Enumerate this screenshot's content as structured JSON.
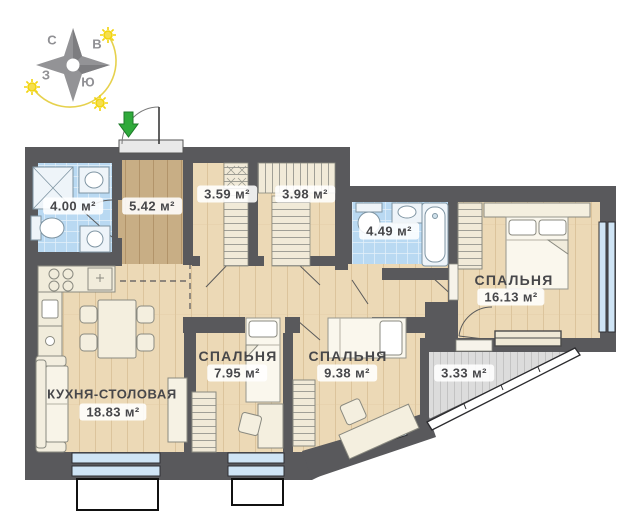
{
  "title": "Apartment floor plan",
  "compass": {
    "letters": {
      "north": "С",
      "east": "В",
      "west": "З",
      "south": "Ю"
    }
  },
  "rooms": {
    "bathroom_small": {
      "area_label": "4.00 м²"
    },
    "hallway": {
      "area_label": "5.42 м²"
    },
    "storage_1": {
      "area_label": "3.59 м²"
    },
    "storage_2": {
      "area_label": "3.98 м²"
    },
    "bathroom_main": {
      "area_label": "4.49 м²"
    },
    "bedroom_main": {
      "name": "СПАЛЬНЯ",
      "area_label": "16.13 м²"
    },
    "bedroom_left": {
      "name": "СПАЛЬНЯ",
      "area_label": "7.95 м²"
    },
    "bedroom_center": {
      "name": "СПАЛЬНЯ",
      "area_label": "9.38 м²"
    },
    "kitchen_dining": {
      "name": "КУХНЯ-СТОЛОВАЯ",
      "area_label": "18.83 м²"
    },
    "balcony": {
      "area_label": "3.33 м²"
    }
  },
  "colors": {
    "wall": "#59595c",
    "floor_wood": "#ecd9b6",
    "floor_wood_dark": "#c8ae85",
    "tile_blue": "#b9d9f2",
    "window_glass": "#cfe4f5",
    "balcony_floor": "#dcdcdc",
    "sun_yellow": "#f2d40c",
    "entry_arrow_green": "#2faa3b"
  }
}
